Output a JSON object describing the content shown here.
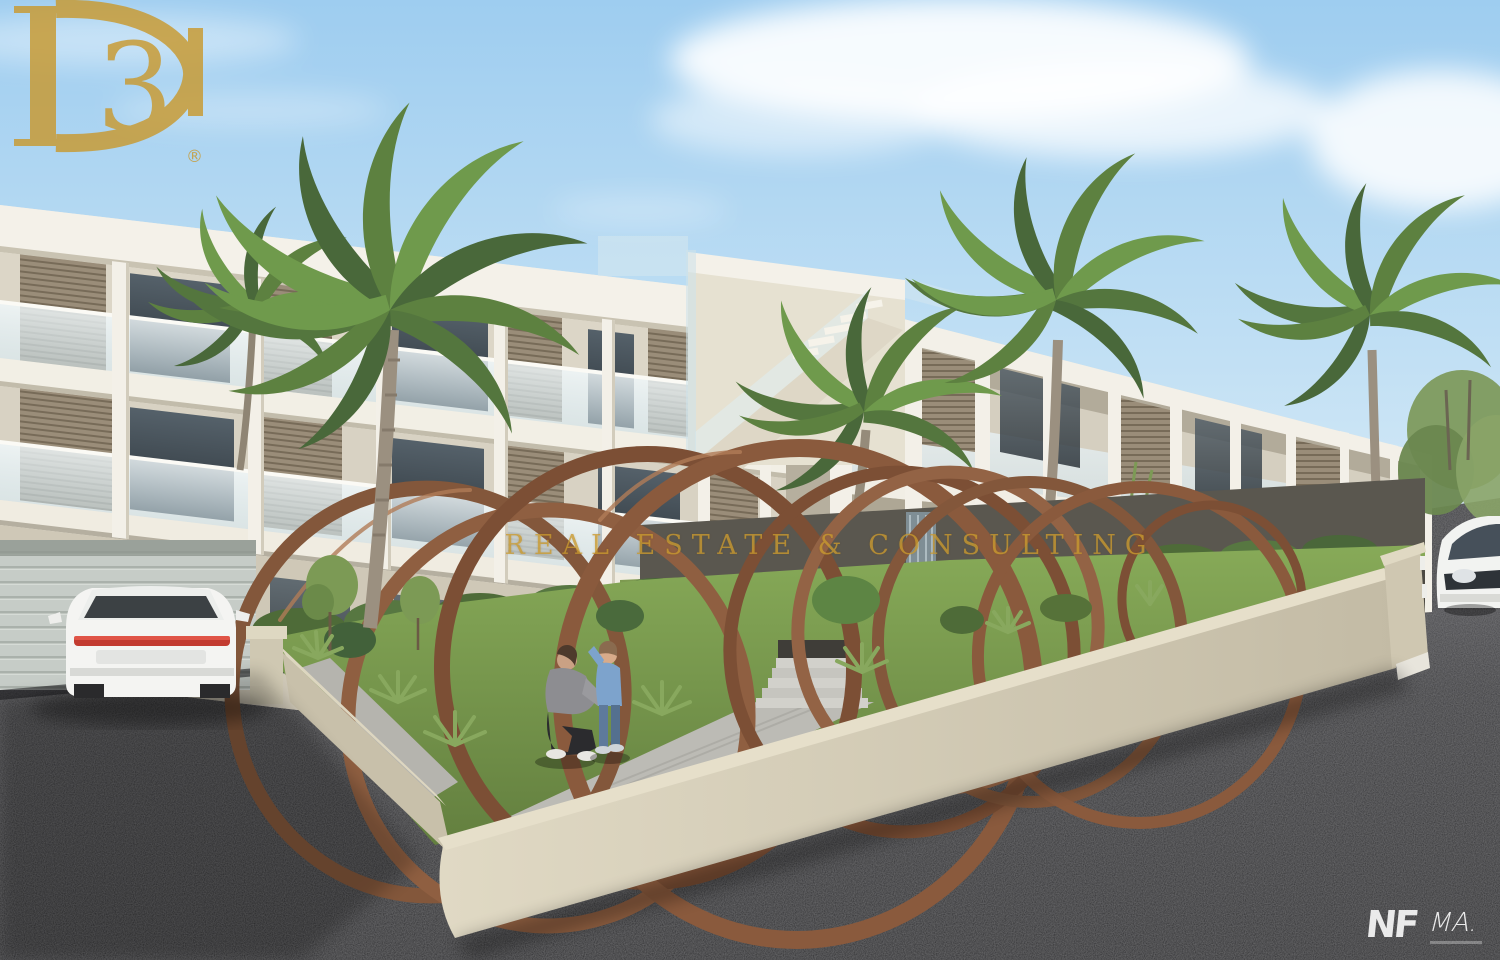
{
  "image": {
    "kind": "3d-architectural-render",
    "subject": "Modern three-storey white apartment complex with palm trees, corten-steel ring sculptures in a corner garden, a woman and child on a walkway, a white SUV parked at a garage and a white sedan at the right edge"
  },
  "watermark": {
    "monogram": "D3",
    "monogram_numeral": "3",
    "registered": "®",
    "tagline": "REAL ESTATE & CONSULTING",
    "color": "#c9992f"
  },
  "credits": {
    "developer_logo": "NF",
    "architect_logo": "MA.",
    "color": "#ffffff"
  },
  "palette": {
    "sky_top": "#9ecdf0",
    "sky_horizon": "#dcedf8",
    "building_white": "#f1eee5",
    "building_shadow": "#d8d2c2",
    "louver_tan": "#9a8d79",
    "glass_balustrade": "#e3eef2",
    "window_dark": "#39424a",
    "rust_ring": "#8a5a3d",
    "grass": "#7aa04f",
    "asphalt": "#2c2c2f",
    "wall_cream": "#d5cdb8",
    "wall_dark": "#56534b",
    "palm_green": "#5d8140"
  }
}
